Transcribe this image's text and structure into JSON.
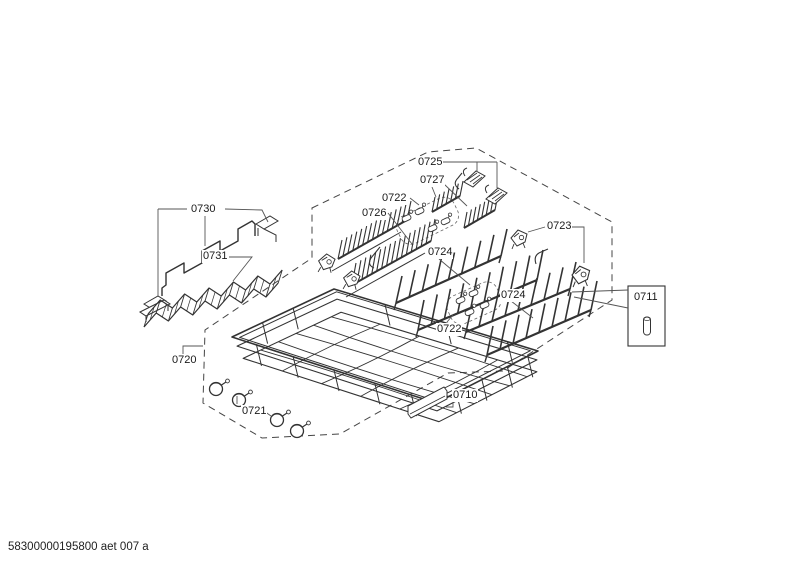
{
  "footer": {
    "code": "58300000195800 aet 007 a"
  },
  "labels": {
    "p0710": "0710",
    "p0711": "0711",
    "p0720": "0720",
    "p0721": "0721",
    "p0722_top": "0722",
    "p0722_bottom": "0722",
    "p0723": "0723",
    "p0724_mid": "0724",
    "p0724_right": "0724",
    "p0725": "0725",
    "p0726": "0726",
    "p0727": "0727",
    "p0730": "0730",
    "p0731": "0731"
  },
  "colors": {
    "line": "#333333",
    "leader": "#555555",
    "dashed_outline": "#444444",
    "label_text": "#1a1a1a",
    "background": "#ffffff"
  }
}
